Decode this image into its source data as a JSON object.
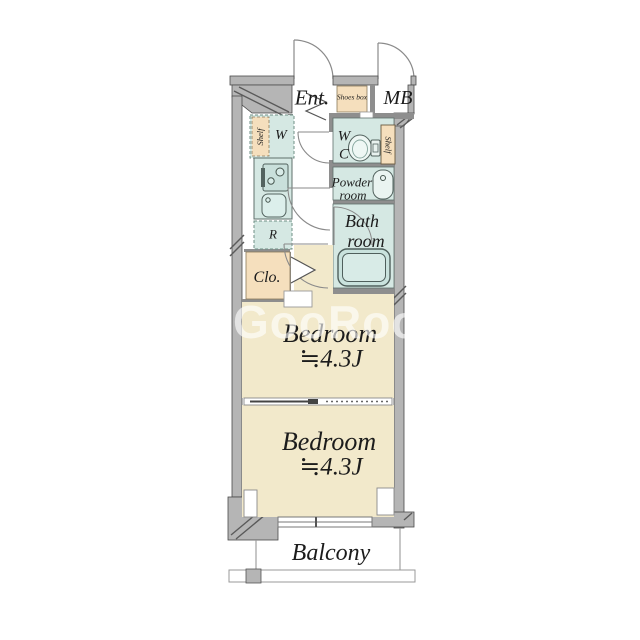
{
  "watermark": {
    "text": "GooRooM"
  },
  "rooms": {
    "entrance": "Ent.",
    "shoes_box": "Shoes box",
    "meter_box": "MB",
    "washer": "W",
    "washer_shelf": "Shelf",
    "wc_line1": "W",
    "wc_line2": "C",
    "wc_shelf": "Shelf",
    "powder_line1": "Powder",
    "powder_line2": "room",
    "bath_line1": "Bath",
    "bath_line2": "room",
    "fridge": "R",
    "closet": "Clo.",
    "bedroom1": {
      "name": "Bedroom",
      "size": "≒4.3J"
    },
    "bedroom2": {
      "name": "Bedroom",
      "size": "≒4.3J"
    },
    "balcony": "Balcony"
  },
  "colors": {
    "wall": "#b5b5b5",
    "wall_line": "#4a4a4a",
    "interior_wall": "#8e8e8e",
    "room_mint": "#d5e8e3",
    "room_beige": "#f2e9cb",
    "storage_beige": "#f5dfbd",
    "text": "#1c1c1c"
  }
}
